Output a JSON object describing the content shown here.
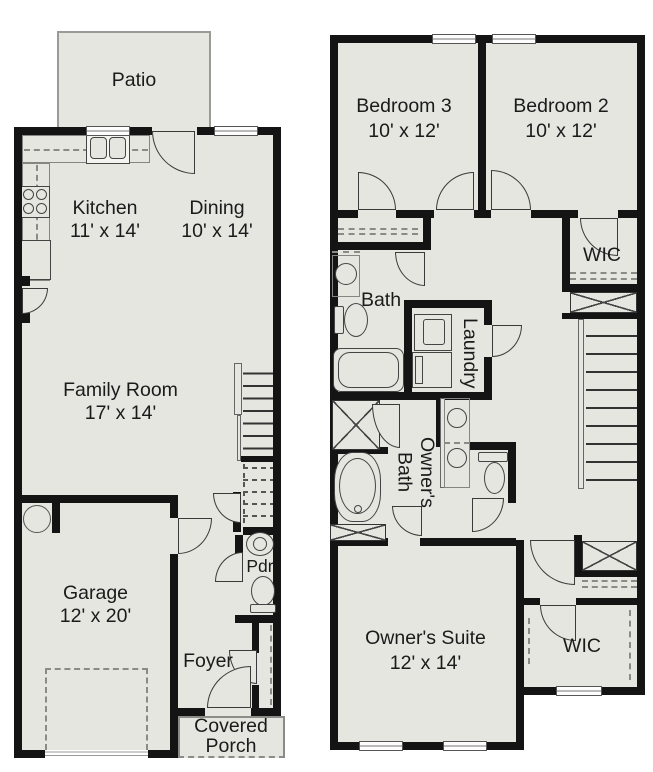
{
  "plan_type": "two-story townhome floor plan",
  "colors": {
    "floor_fill": "#e4e6df",
    "wall": "#141414",
    "background": "#ffffff",
    "text": "#1b1b1b"
  },
  "floors": {
    "first": {
      "patio": {
        "label": "Patio"
      },
      "kitchen": {
        "label": "Kitchen",
        "dims": "11' x 14'"
      },
      "dining": {
        "label": "Dining",
        "dims": "10' x 14'"
      },
      "family_room": {
        "label": "Family Room",
        "dims": "17' x 14'"
      },
      "garage": {
        "label": "Garage",
        "dims": "12' x 20'"
      },
      "powder": {
        "label": "Pdr"
      },
      "foyer": {
        "label": "Foyer"
      },
      "covered_porch": {
        "label": "Covered Porch"
      }
    },
    "second": {
      "bedroom3": {
        "label": "Bedroom 3",
        "dims": "10' x 12'"
      },
      "bedroom2": {
        "label": "Bedroom 2",
        "dims": "10' x 12'"
      },
      "wic_upper": {
        "label": "WIC"
      },
      "bath": {
        "label": "Bath"
      },
      "laundry": {
        "label": "Laundry"
      },
      "owners_bath": {
        "label": "Owner's Bath"
      },
      "owners_suite": {
        "label": "Owner's Suite",
        "dims": "12' x 14'"
      },
      "wic_lower": {
        "label": "WIC"
      }
    }
  }
}
